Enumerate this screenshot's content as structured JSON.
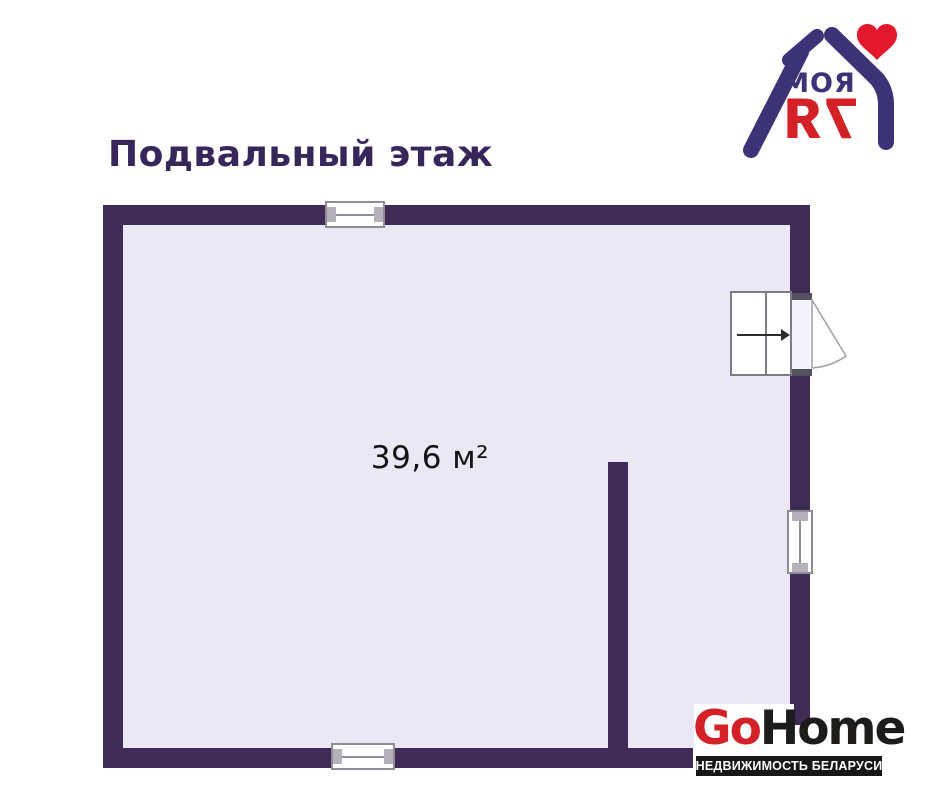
{
  "title": "Подвальный этаж",
  "plan": {
    "area_label": "39,6 м²"
  },
  "logo_moya7ya": {
    "word_top": "МОЯ",
    "word_bottom": "7Я"
  },
  "logo_gohome": {
    "part_red": "Go",
    "part_dark": "Home",
    "tagline": "НЕДВИЖИМОСТЬ БЕЛАРУСИ"
  },
  "colors": {
    "wall": "#3e2c57",
    "floor": "#ebe8f6",
    "ink": "#36265a",
    "brand-red": "#d32127",
    "brand-navy": "#3c3376",
    "heart-red": "#e4182c",
    "banner-black": "#17171a",
    "area-text": "#141414"
  }
}
